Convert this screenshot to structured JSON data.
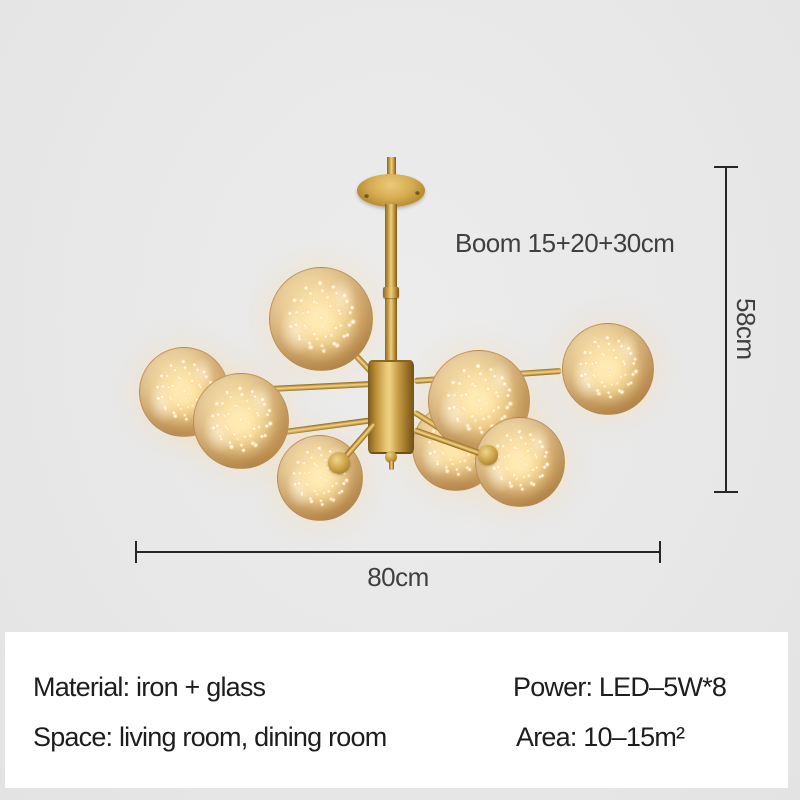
{
  "figure": {
    "description": "Gold sputnik chandelier with 8 amber glass globes filled with glowing LED string lights, shown on a light gray background with dimension annotations"
  },
  "annotations": {
    "boom": "Boom 15+20+30cm",
    "height": "58cm",
    "width": "80cm"
  },
  "specs": {
    "rows": [
      {
        "left": "Material: iron + glass",
        "right": "Power: LED–5W*8"
      },
      {
        "left": "Space: living room, dining room",
        "right": "Area: 10–15m²"
      }
    ]
  },
  "colors": {
    "background": "#e9e9e9",
    "panel": "#ffffff",
    "gold": "#c9a24a",
    "glass_amber": "#e8c48a",
    "light_glow": "#ffe9b8",
    "dimension_line": "#262626",
    "dimension_text": "#3f3f3f",
    "spec_text": "#1d1d1d"
  }
}
